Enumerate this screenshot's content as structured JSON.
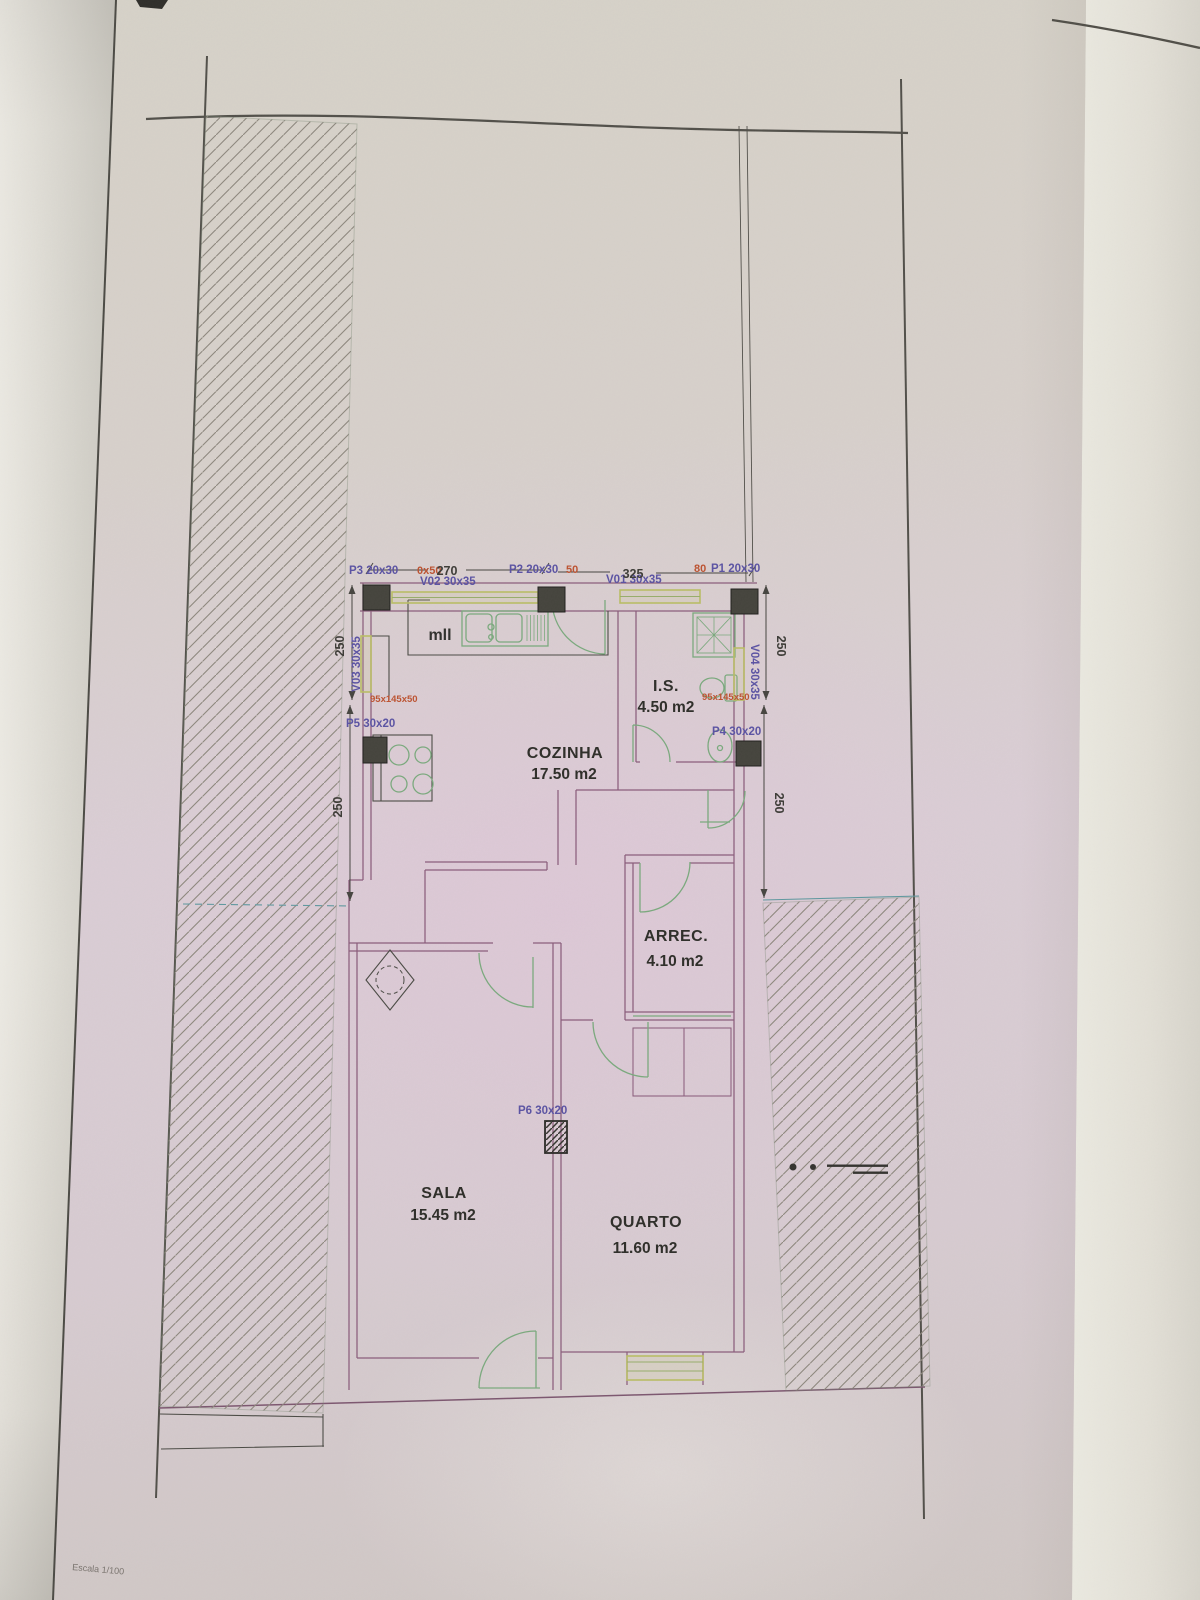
{
  "meta": {
    "document_type": "photographed architectural floor plan page",
    "scale_note": "Escala 1/100"
  },
  "palette": {
    "label_blue": "#5a52a6",
    "label_red": "#c0512e",
    "wall_purple": "#8b5c7c",
    "fixture_green": "#79aa7c",
    "window_yellow_green": "#b9bd62",
    "ink_dark": "#2d2d28",
    "paper_pink": "#dacdd5"
  },
  "labels": {
    "cozinha": "COZINHA",
    "cozinha_area": "17.50 m2",
    "is": "I.S.",
    "is_area": "4.50 m2",
    "arrec": "ARREC.",
    "arrec_area": "4.10 m2",
    "sala": "SALA",
    "sala_area": "15.45 m2",
    "quarto": "QUARTO",
    "quarto_area": "11.60 m2",
    "p1": "P1 20x30",
    "p1_note": "80",
    "p2": "P2 20x30",
    "p2_note": "50",
    "p3": "P3 20x30",
    "p3_note": "0x50",
    "p4": "P4 30x20",
    "p5": "P5 30x20",
    "p6": "P6 30x20",
    "v01": "V01 30x35",
    "v02": "V02 30x35",
    "v03": "V03 30x35",
    "v04": "V04 30x35",
    "worktop_left": "95x145x50",
    "worktop_right": "95x145x50",
    "counter": "mll",
    "dim_270": "270",
    "dim_325": "325",
    "dim_250_left_upper": "250",
    "dim_250_left_lower": "250",
    "dim_250_right_upper": "250",
    "dim_250_right_lower": "250",
    "scale": "Escala 1/100"
  }
}
